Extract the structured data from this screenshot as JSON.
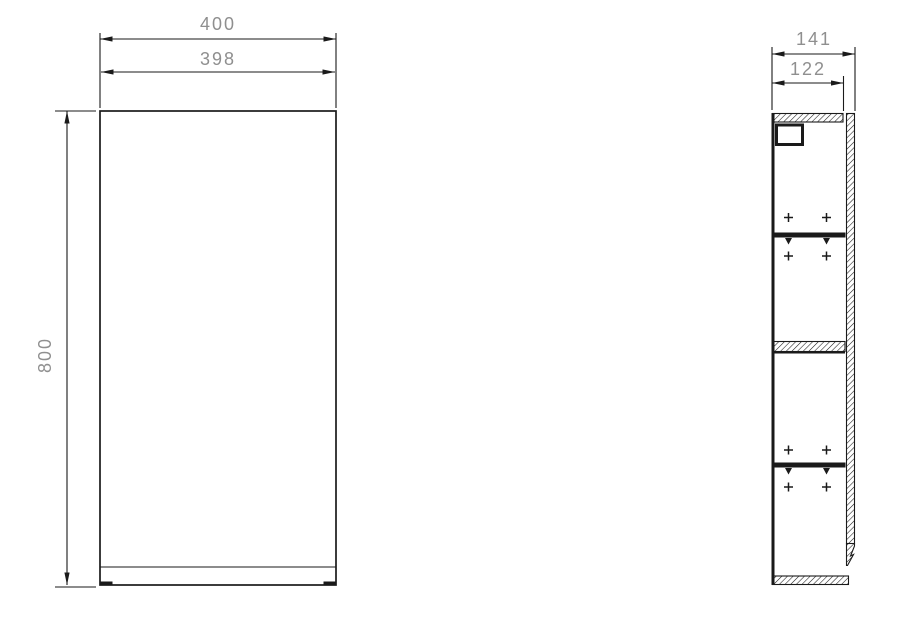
{
  "drawing": {
    "front_view": {
      "width_label": "400",
      "door_width_label": "398",
      "height_label": "800"
    },
    "side_view": {
      "depth_label": "141",
      "carcass_depth_label": "122"
    },
    "colors": {
      "line": "#1a1a1a",
      "dim_text": "#8f8f8f",
      "background": "#ffffff"
    }
  }
}
